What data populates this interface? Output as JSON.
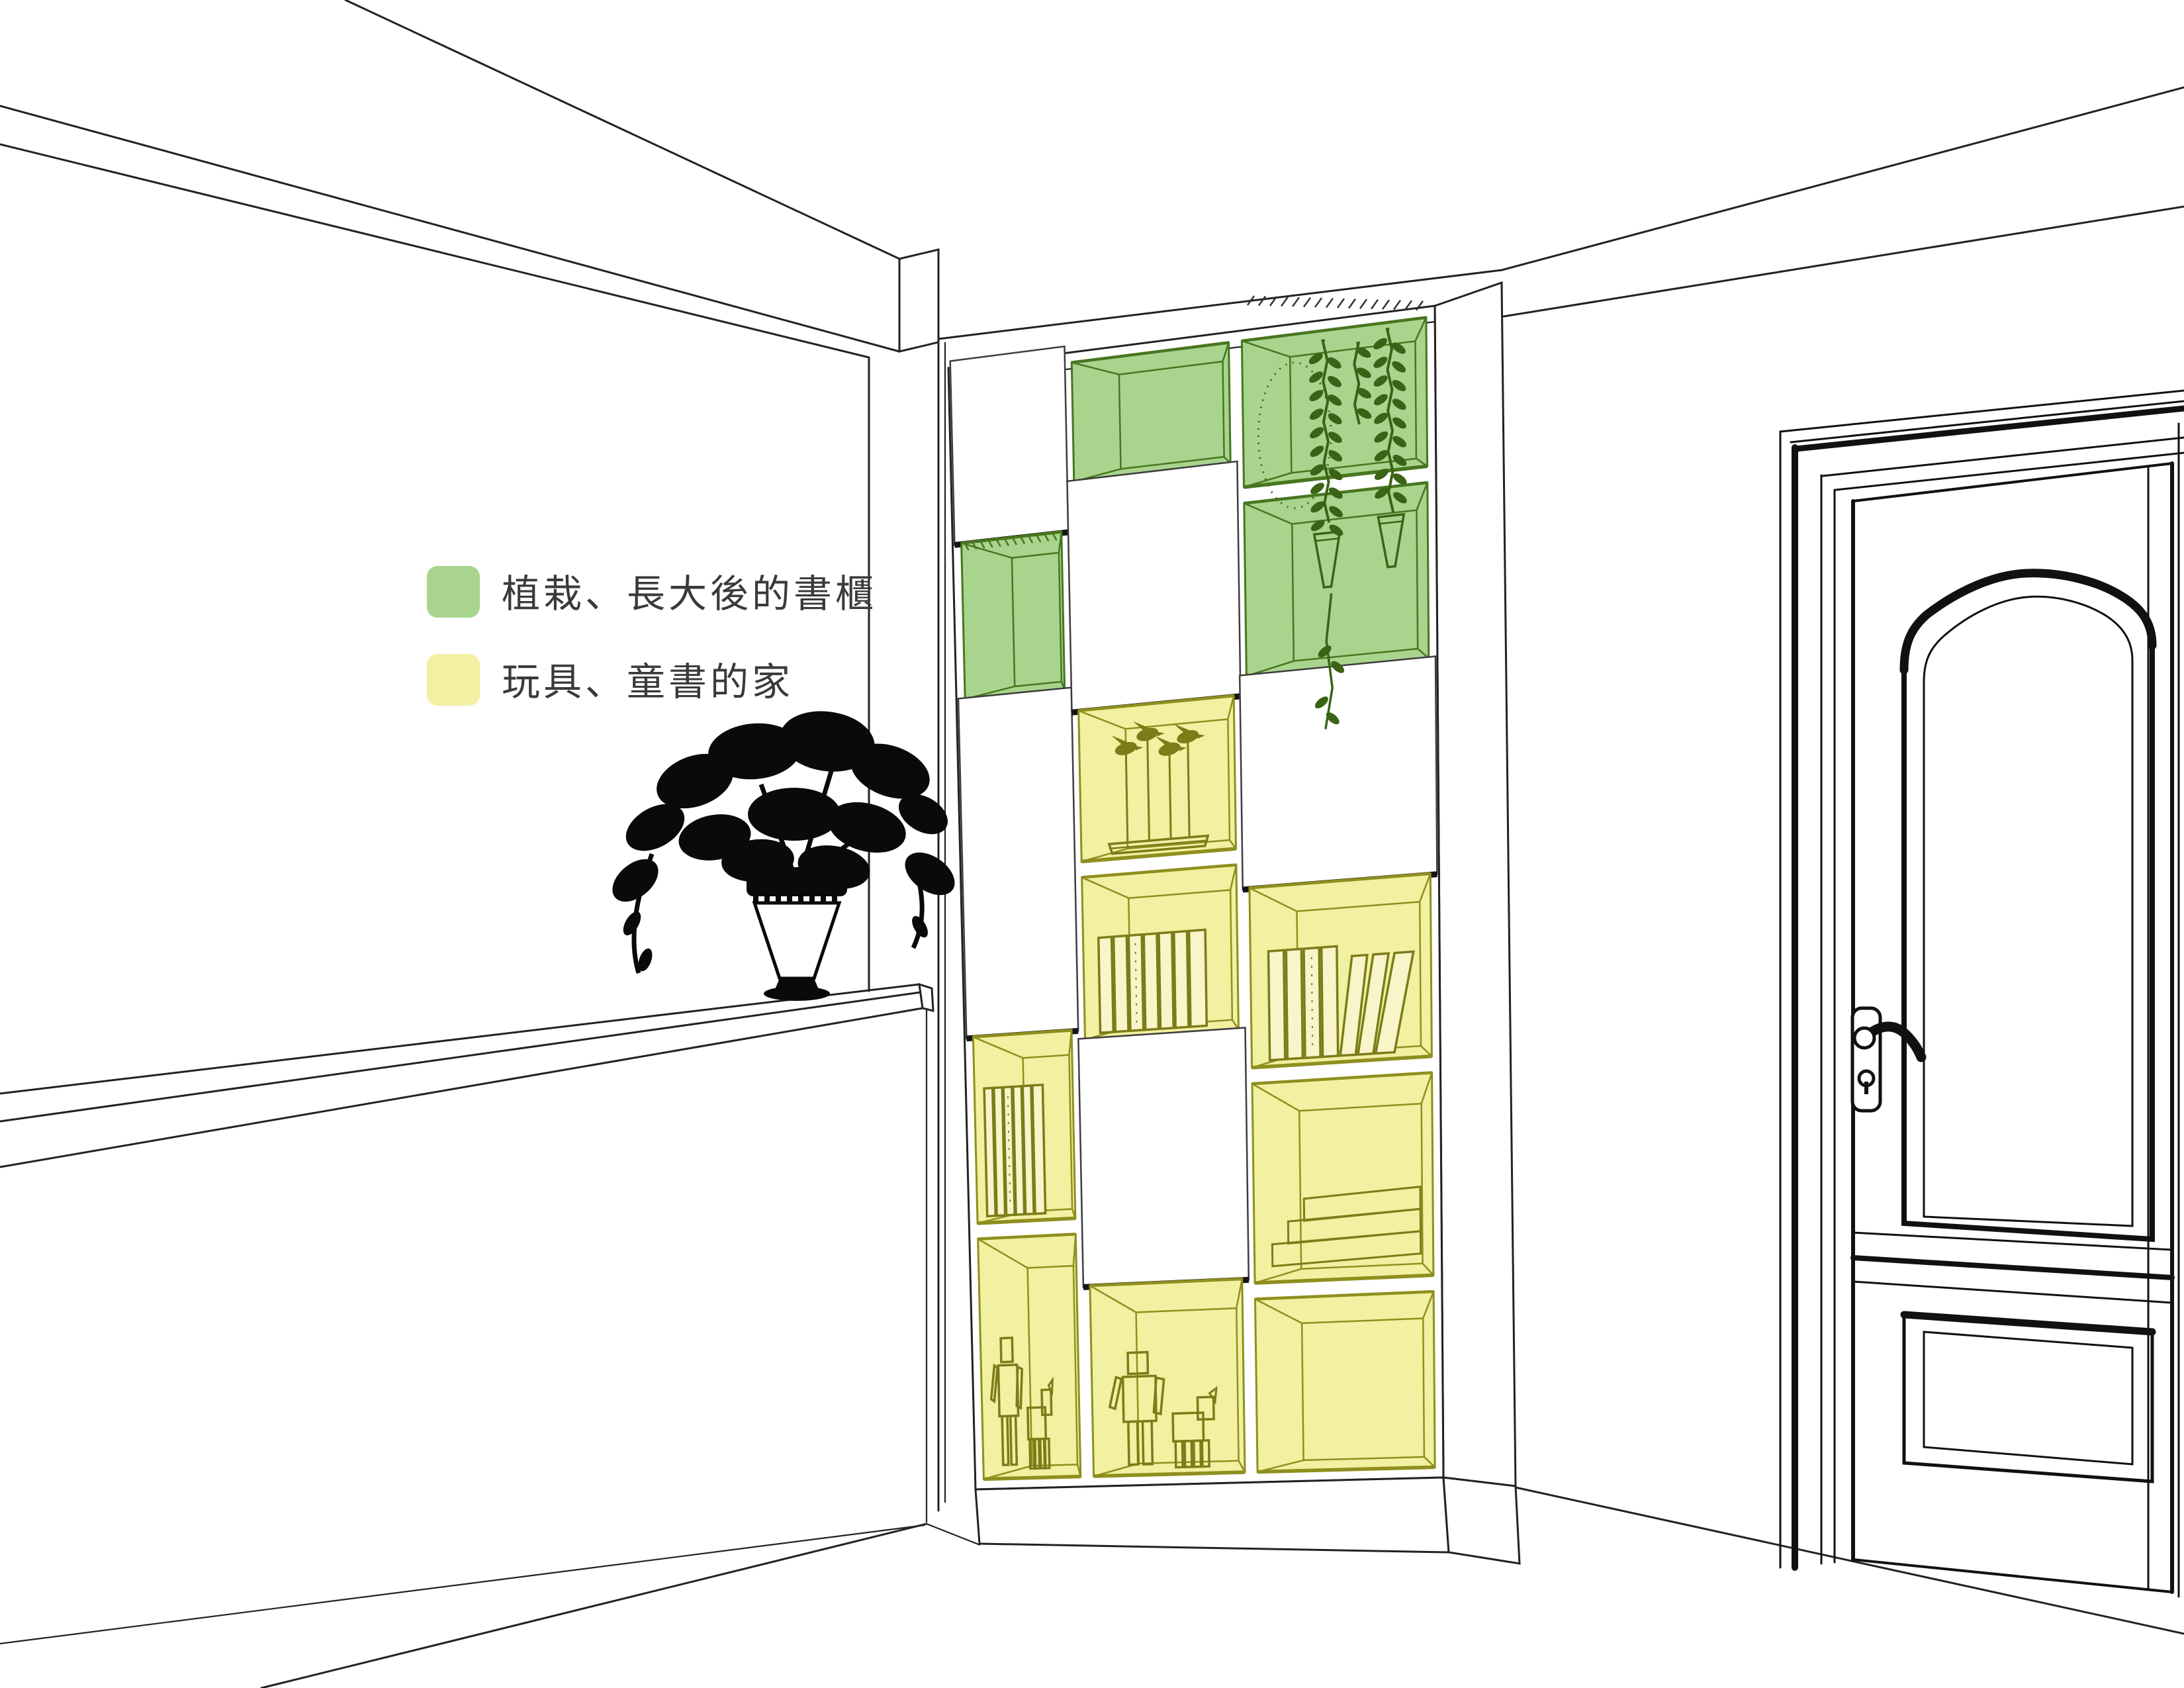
{
  "legend": {
    "items": [
      {
        "name": "green",
        "label": "植栽、長大後的書櫃",
        "swatch": "#a9d48e"
      },
      {
        "name": "yellow",
        "label": "玩具、童書的家",
        "swatch": "#f2f0a1"
      }
    ]
  },
  "colors": {
    "background": "#ffffff",
    "line": "#222222",
    "heavy": "#111111",
    "text": "#3a3a3a",
    "green_fill": "#a9d48e",
    "green_line": "#47761f",
    "yellow_fill": "#f2f0a1",
    "yellow_line": "#8f8f1e",
    "content_line": "#7c7c19",
    "plant_line": "#3a6315",
    "silhouette": "#0a0a0a"
  },
  "cabinet": {
    "columns": [
      {
        "cells": [
          {
            "fill": "white",
            "state": "closed"
          },
          {
            "fill": "green",
            "content": "empty"
          },
          {
            "fill": "white",
            "state": "closed"
          },
          {
            "fill": "yellow",
            "content": "books"
          },
          {
            "fill": "yellow",
            "content": "robots"
          }
        ]
      },
      {
        "cells": [
          {
            "fill": "green",
            "content": "empty"
          },
          {
            "fill": "white",
            "state": "closed"
          },
          {
            "fill": "yellow",
            "content": "sculpture"
          },
          {
            "fill": "yellow",
            "content": "books"
          },
          {
            "fill": "white",
            "state": "closed"
          },
          {
            "fill": "yellow",
            "content": "robots"
          }
        ]
      },
      {
        "cells": [
          {
            "fill": "green",
            "content": "plant"
          },
          {
            "fill": "green",
            "content": "plant-continued"
          },
          {
            "fill": "white",
            "state": "closed"
          },
          {
            "fill": "yellow",
            "content": "books-leaning"
          },
          {
            "fill": "yellow",
            "content": "stairs"
          },
          {
            "fill": "yellow",
            "content": "empty"
          }
        ]
      }
    ]
  }
}
